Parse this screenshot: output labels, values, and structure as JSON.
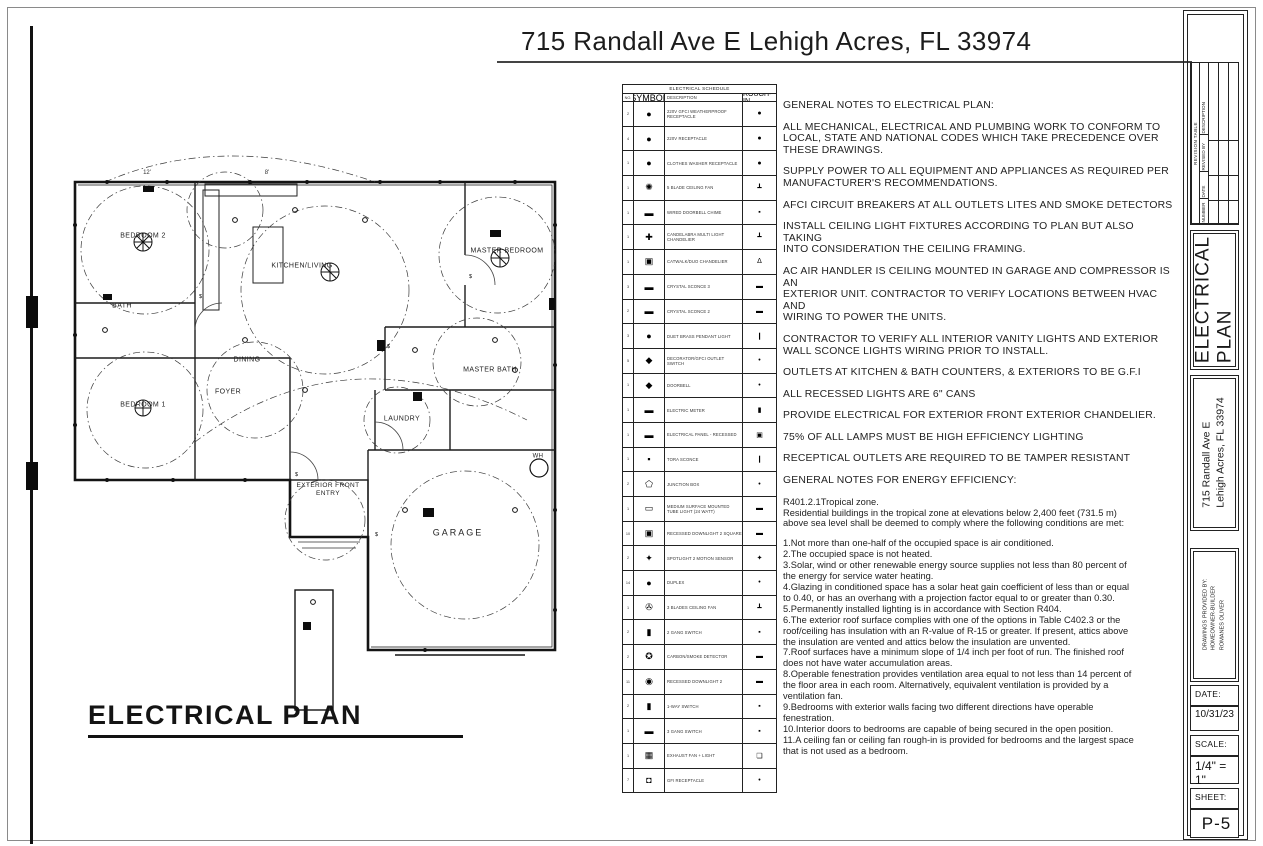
{
  "sheet": {
    "top_title": "715 Randall Ave E Lehigh Acres, FL 33974",
    "plan_heading": "ELECTRICAL PLAN"
  },
  "floor_plan": {
    "rooms": [
      {
        "label": "BEDROOM 2",
        "x": 98,
        "y": 147
      },
      {
        "label": "BATH",
        "x": 77,
        "y": 217
      },
      {
        "label": "KITCHEN/LIVING",
        "x": 257,
        "y": 177
      },
      {
        "label": "MASTER BEDROOM",
        "x": 462,
        "y": 162
      },
      {
        "label": "BEDROOM 1",
        "x": 98,
        "y": 316
      },
      {
        "label": "DINING",
        "x": 202,
        "y": 271
      },
      {
        "label": "FOYER",
        "x": 183,
        "y": 303
      },
      {
        "label": "MASTER BATH",
        "x": 445,
        "y": 281
      },
      {
        "label": "LAUNDRY",
        "x": 357,
        "y": 330
      },
      {
        "label": "EXTERIOR FRONT\nENTRY",
        "x": 283,
        "y": 400,
        "size": 6.5
      },
      {
        "label": "GARAGE",
        "x": 413,
        "y": 443,
        "size": 9,
        "ls": 2
      },
      {
        "label": "WH",
        "x": 493,
        "y": 367,
        "size": 6
      }
    ],
    "dimensions": [
      {
        "label": "12'",
        "x": 102,
        "y": 83
      },
      {
        "label": "8'",
        "x": 222,
        "y": 83
      }
    ]
  },
  "schedule": {
    "title": "ELECTRICAL SCHEDULE",
    "columns": [
      "NO.",
      "SYMBOL",
      "DESCRIPTION",
      "ROUGH-IN"
    ],
    "rows": [
      {
        "qty": "2",
        "symbol": "●",
        "desc": "220V GFCI WEATHERPROOF RECEPTACLE",
        "rough": "●"
      },
      {
        "qty": "4",
        "symbol": "●",
        "desc": "220V RECEPTACLE",
        "rough": "●"
      },
      {
        "qty": "1",
        "symbol": "●",
        "desc": "CLOTHES WASHER RECEPTACLE",
        "rough": "●"
      },
      {
        "qty": "1",
        "symbol": "✺",
        "desc": "5 BLADE CEILING FAN",
        "rough": "┻"
      },
      {
        "qty": "1",
        "symbol": "▬",
        "desc": "WIRED DOORBELL CHIME",
        "rough": "▪"
      },
      {
        "qty": "1",
        "symbol": "✚",
        "desc": "CANDELABRA MULTI LIGHT CHANDELIER",
        "rough": "┻"
      },
      {
        "qty": "1",
        "symbol": "▣",
        "desc": "CATWALK/DUO CHANDELIER",
        "rough": "Δ"
      },
      {
        "qty": "3",
        "symbol": "▬",
        "desc": "CRYSTAL SCONCE 3",
        "rough": "▬"
      },
      {
        "qty": "2",
        "symbol": "▬",
        "desc": "CRYSTAL SCONCE 2",
        "rough": "▬"
      },
      {
        "qty": "3",
        "symbol": "●",
        "desc": "DUET BRASS PENDANT LIGHT",
        "rough": "❙"
      },
      {
        "qty": "5",
        "symbol": "◆",
        "desc": "DECORATOR/GFCI OUTLET SWITCH",
        "rough": "•"
      },
      {
        "qty": "1",
        "symbol": "◆",
        "desc": "DOORBELL",
        "rough": "•"
      },
      {
        "qty": "1",
        "symbol": "▬",
        "desc": "ELECTRIC METER",
        "rough": "▮"
      },
      {
        "qty": "1",
        "symbol": "▬",
        "desc": "ELECTRICAL PANEL - RECESSED",
        "rough": "▣"
      },
      {
        "qty": "1",
        "symbol": "▪",
        "desc": "TORA SCONCE",
        "rough": "❙"
      },
      {
        "qty": "2",
        "symbol": "⬠",
        "desc": "JUNCTION BOX",
        "rough": "•"
      },
      {
        "qty": "1",
        "symbol": "▭",
        "desc": "MEDIUM SURFACE MOUNTED TUBE LIGHT (24 WATT)",
        "rough": "▬"
      },
      {
        "qty": "10",
        "symbol": "▣",
        "desc": "RECESSED DOWNLIGHT 2 SQUARE",
        "rough": "▬"
      },
      {
        "qty": "2",
        "symbol": "✦",
        "desc": "SPOTLIGHT 2 MOTION SENSOR",
        "rough": "✦"
      },
      {
        "qty": "14",
        "symbol": "●",
        "desc": "DUPLEX",
        "rough": "•"
      },
      {
        "qty": "1",
        "symbol": "✇",
        "desc": "3 BLADES CEILING FAN",
        "rough": "┻"
      },
      {
        "qty": "2",
        "symbol": "▮",
        "desc": "2 GANG SWITCH",
        "rough": "▪"
      },
      {
        "qty": "2",
        "symbol": "✪",
        "desc": "CARBON/SMOKE DETECTOR",
        "rough": "▬"
      },
      {
        "qty": "11",
        "symbol": "◉",
        "desc": "RECESSED DOWNLIGHT 2",
        "rough": "▬"
      },
      {
        "qty": "2",
        "symbol": "▮",
        "desc": "1-WAY SWITCH",
        "rough": "▪"
      },
      {
        "qty": "1",
        "symbol": "▬",
        "desc": "3 GANG SWITCH",
        "rough": "▪"
      },
      {
        "qty": "1",
        "symbol": "▦",
        "desc": "EXHAUST FAN + LIGHT",
        "rough": "❏"
      },
      {
        "qty": "7",
        "symbol": "◘",
        "desc": "GFI RECEPTACLE",
        "rough": "•"
      }
    ]
  },
  "notes": {
    "caps_paragraphs": [
      "GENERAL NOTES TO ELECTRICAL PLAN:",
      "ALL MECHANICAL, ELECTRICAL AND PLUMBING WORK TO CONFORM TO\nLOCAL, STATE AND NATIONAL CODES WHICH TAKE PRECEDENCE OVER\nTHESE DRAWINGS.",
      "SUPPLY POWER TO ALL EQUIPMENT AND APPLIANCES AS REQUIRED PER\nMANUFACTURER'S RECOMMENDATIONS.",
      "AFCI CIRCUIT BREAKERS AT ALL OUTLETS LITES AND SMOKE DETECTORS",
      "INSTALL CEILING LIGHT FIXTURES ACCORDING TO PLAN BUT ALSO TAKING\nINTO CONSIDERATION THE CEILING FRAMING.",
      "AC AIR HANDLER IS CEILING MOUNTED IN GARAGE AND COMPRESSOR IS AN\nEXTERIOR UNIT. CONTRACTOR TO VERIFY LOCATIONS BETWEEN HVAC AND\nWIRING TO POWER THE UNITS.",
      "CONTRACTOR TO VERIFY ALL INTERIOR VANITY LIGHTS AND EXTERIOR\nWALL SCONCE LIGHTS WIRING  PRIOR TO INSTALL.",
      "OUTLETS AT KITCHEN & BATH COUNTERS, & EXTERIORS TO BE G.F.I",
      "ALL RECESSED LIGHTS ARE 6\" CANS",
      "PROVIDE ELECTRICAL FOR EXTERIOR FRONT EXTERIOR CHANDELIER.",
      "75% OF ALL LAMPS MUST BE HIGH EFFICIENCY LIGHTING",
      "RECEPTICAL OUTLETS ARE REQUIRED TO BE TAMPER RESISTANT",
      "GENERAL NOTES FOR ENERGY EFFICIENCY:"
    ],
    "energy_paragraphs": [
      "R401.2.1Tropical zone.\nResidential buildings in the tropical zone at elevations below 2,400 feet (731.5 m)\nabove sea level shall be deemed to comply where the following conditions are met:",
      "1.Not more than one-half of the occupied space is air conditioned.\n2.The occupied space is not heated.\n3.Solar, wind or other renewable energy source supplies not less than 80 percent of\nthe energy for service water heating.\n4.Glazing in conditioned space has a solar heat gain coefficient of less than or equal\nto 0.40, or has an overhang with a projection factor equal to or greater than 0.30.\n5.Permanently installed lighting is in accordance with Section R404.\n6.The exterior roof surface complies with one of the options in Table C402.3 or the\nroof/ceiling has insulation with an R-value of R-15 or greater. If present, attics above\nthe insulation are vented and attics below the insulation are unvented.\n7.Roof surfaces have a minimum slope of 1/4 inch per foot of run. The finished roof\ndoes not have water accumulation areas.\n8.Operable fenestration provides ventilation area equal to not less than 14 percent of\nthe floor area in each room. Alternatively, equivalent ventilation is provided by a\nventilation fan.\n9.Bedrooms with exterior walls facing two different directions have operable\nfenestration.\n10.Interior doors to bedrooms are capable of being secured in the open position.\n11.A ceiling fan or ceiling fan rough-in is provided for bedrooms and the largest space\nthat is not used as a bedroom."
    ]
  },
  "title_block": {
    "revision": {
      "title": "REVISION TABLE",
      "columns": [
        "NUMBER",
        "DATE",
        "REVISED BY",
        "DESCRIPTION"
      ]
    },
    "sheet_name": "ELECTRICAL\nPLAN",
    "address": "715 Randall Ave E\nLehigh Acres, FL 33974",
    "provided_by": "DRAWINGS PROVIDED BY:\n   HOMEOWNER-BUILDER\n   ROMANES OLIVER",
    "date_label": "DATE:",
    "date": "10/31/23",
    "scale_label": "SCALE:",
    "scale": "1/4\" = 1\"",
    "sheet_label": "SHEET:",
    "sheet_number": "P-5"
  }
}
